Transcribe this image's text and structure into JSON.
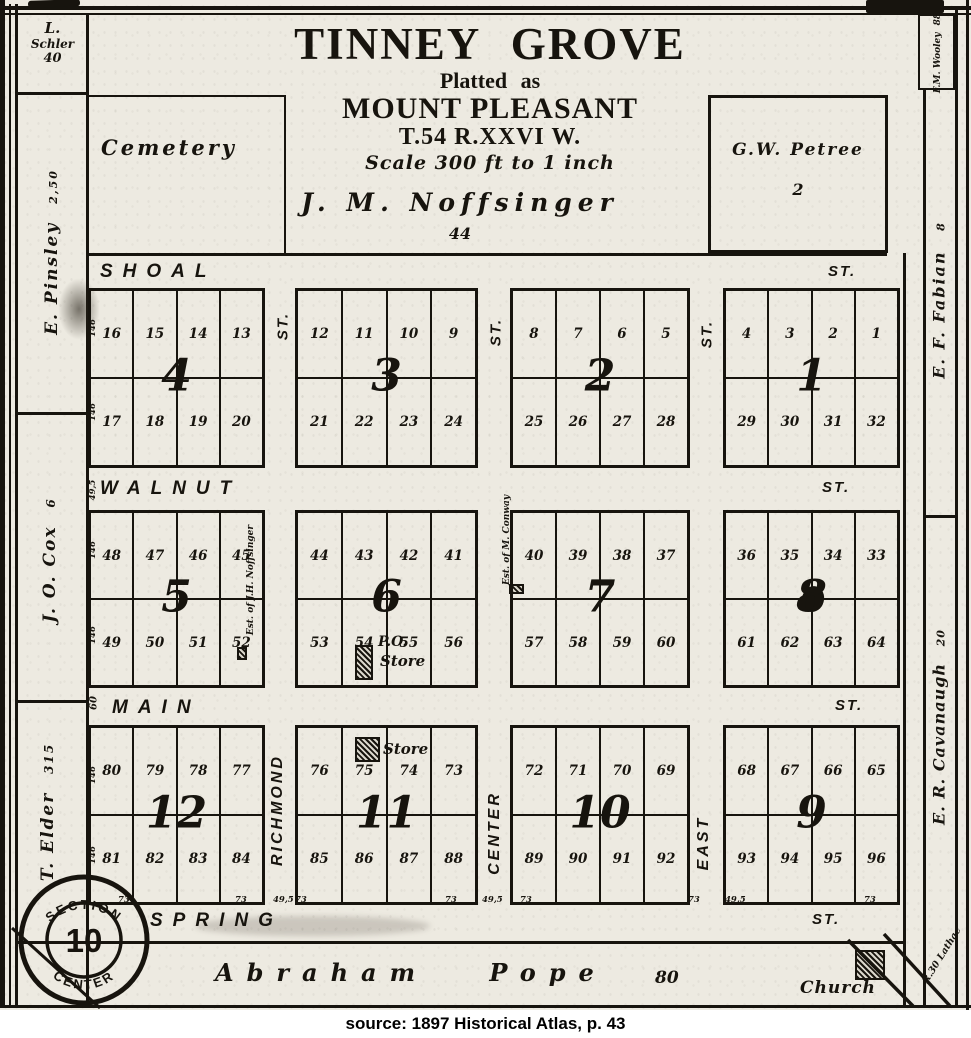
{
  "caption": "source: 1897 Historical Atlas, p. 43",
  "title_block": {
    "main": "TINNEY GROVE",
    "sub1": "Platted as",
    "sub2": "MOUNT PLEASANT",
    "township": "T.54  R.XXVI W.",
    "scale": "Scale 300 ft to 1 inch"
  },
  "parcels": {
    "cemetery": {
      "label": "Cemetery"
    },
    "petree": {
      "name": "G.W. Petree",
      "acres": "2"
    },
    "noffsinger": {
      "name": "J. M. Noffsinger",
      "acres": "44"
    },
    "pope": {
      "name": "Abraham Pope",
      "acres": "80"
    },
    "church": {
      "label": "Church"
    }
  },
  "margin_parcels": {
    "schler": {
      "line1": "L.",
      "line2": "Schler",
      "acres": "40"
    },
    "pinsley": {
      "name": "E. Pinsley",
      "acres": "2,50"
    },
    "cox": {
      "name": "J. O. Cox",
      "acres": "6"
    },
    "elder": {
      "name": "T. Elder",
      "acres": "315"
    },
    "wooley": {
      "name": "F.M. Wooley",
      "acres": "88"
    },
    "fabian": {
      "name": "E. F. Fabian",
      "acres": "8"
    },
    "cavanaugh": {
      "name": "E. R. Cavanaugh",
      "acres": "20"
    },
    "lathae": {
      "name": "R.30 Lathae"
    }
  },
  "section_stamp": {
    "arc_top": "SECTION",
    "arc_bottom": "CENTER",
    "number": "10"
  },
  "streets": {
    "horizontal": [
      {
        "name": "SHOAL",
        "suffix": "ST."
      },
      {
        "name": "WALNUT",
        "suffix": "ST."
      },
      {
        "name": "MAIN",
        "suffix": "ST."
      },
      {
        "name": "SPRING",
        "suffix": "ST."
      }
    ],
    "vertical_row1_suffix": [
      "ST.",
      "ST.",
      "ST."
    ],
    "vertical_row3": [
      "RICHMOND",
      "CENTER",
      "EAST"
    ]
  },
  "block_rows": [
    {
      "blocks": [
        {
          "number": "4",
          "top": [
            "16",
            "15",
            "14",
            "13"
          ],
          "bottom": [
            "17",
            "18",
            "19",
            "20"
          ]
        },
        {
          "number": "3",
          "top": [
            "12",
            "11",
            "10",
            "9"
          ],
          "bottom": [
            "21",
            "22",
            "23",
            "24"
          ]
        },
        {
          "number": "2",
          "top": [
            "8",
            "7",
            "6",
            "5"
          ],
          "bottom": [
            "25",
            "26",
            "27",
            "28"
          ]
        },
        {
          "number": "1",
          "top": [
            "4",
            "3",
            "2",
            "1"
          ],
          "bottom": [
            "29",
            "30",
            "31",
            "32"
          ]
        }
      ]
    },
    {
      "blocks": [
        {
          "number": "5",
          "top": [
            "48",
            "47",
            "46",
            "45"
          ],
          "bottom": [
            "49",
            "50",
            "51",
            "52"
          ]
        },
        {
          "number": "6",
          "top": [
            "44",
            "43",
            "42",
            "41"
          ],
          "bottom": [
            "53",
            "54",
            "55",
            "56"
          ]
        },
        {
          "number": "7",
          "top": [
            "40",
            "39",
            "38",
            "37"
          ],
          "bottom": [
            "57",
            "58",
            "59",
            "60"
          ]
        },
        {
          "number": "8",
          "top": [
            "36",
            "35",
            "34",
            "33"
          ],
          "bottom": [
            "61",
            "62",
            "63",
            "64"
          ]
        }
      ]
    },
    {
      "blocks": [
        {
          "number": "12",
          "top": [
            "80",
            "79",
            "78",
            "77"
          ],
          "bottom": [
            "81",
            "82",
            "83",
            "84"
          ]
        },
        {
          "number": "11",
          "top": [
            "76",
            "75",
            "74",
            "73"
          ],
          "bottom": [
            "85",
            "86",
            "87",
            "88"
          ]
        },
        {
          "number": "10",
          "top": [
            "72",
            "71",
            "70",
            "69"
          ],
          "bottom": [
            "89",
            "90",
            "91",
            "92"
          ]
        },
        {
          "number": "9",
          "top": [
            "68",
            "67",
            "66",
            "65"
          ],
          "bottom": [
            "93",
            "94",
            "95",
            "96"
          ]
        }
      ]
    }
  ],
  "annotations": {
    "po": "P.O.",
    "po_store": "Store",
    "store11": "Store",
    "noffsinger_est": "Est. of J.H. Noffsinger",
    "conway_est": "Est. of M. Conway",
    "main_dim": "60"
  },
  "edge_dims": [
    "146",
    "146",
    "49,5",
    "146",
    "146",
    "146",
    "146"
  ],
  "bottom_dims": [
    "73",
    "73",
    "49,5",
    "73",
    "73",
    "49,5",
    "73",
    "73",
    "49,5",
    "73"
  ]
}
